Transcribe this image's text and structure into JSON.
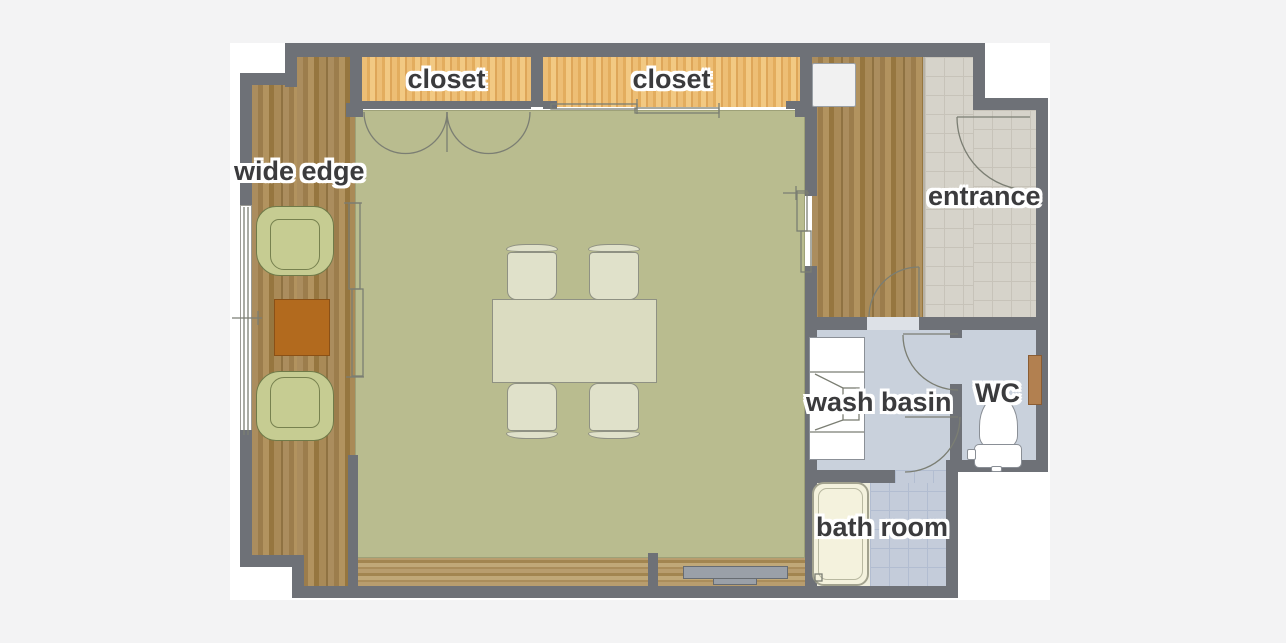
{
  "plan_type": "apartment floor plan",
  "labels": {
    "wide_edge": "wide edge",
    "closet_1": "closet",
    "closet_2": "closet",
    "entrance": "entrance",
    "wash_basin": "wash basin",
    "wc": "WC",
    "bath_room": "bath room"
  },
  "furniture": {
    "armchairs": "two green armchairs facing each other on the wide edge",
    "side_table": "orange-brown square side table",
    "dining_table": "rectangular dining table",
    "dining_chairs": "four dining chairs",
    "cabinet": "white cabinet at hallway top",
    "vanity": "wash basin vanity unit with sink",
    "toilet": "toilet with tank",
    "wc_shelf": "small wooden shelf in WC",
    "bathtub": "bathtub",
    "window_track": "gray sliding-window sill at bottom of main room"
  },
  "colors": {
    "page_bg": "#f3f3f4",
    "canvas": "#ffffff",
    "wall": "#6e7177",
    "wood": "#a5875a",
    "wood_light": "#b59a6b",
    "closet_wood": "#ecbd74",
    "floor_main": "#b9bc8f",
    "tile_entrance": "#d6d3ca",
    "tile_grout": "#c7c3b9",
    "wet_floor": "#c9d1dc",
    "bath_tile": "#c4ccda",
    "bath_grout": "#b2bdd1",
    "furniture_fill": "#e0e1ca",
    "dining_table": "#dbdcc1",
    "armchair": "#c6cc92",
    "table_accent": "#b26a1e",
    "bathtub": "#f4f2dd",
    "window_track": "#9aa0a8",
    "label_text": "#3b3b3d",
    "line": "#7b7e73"
  }
}
